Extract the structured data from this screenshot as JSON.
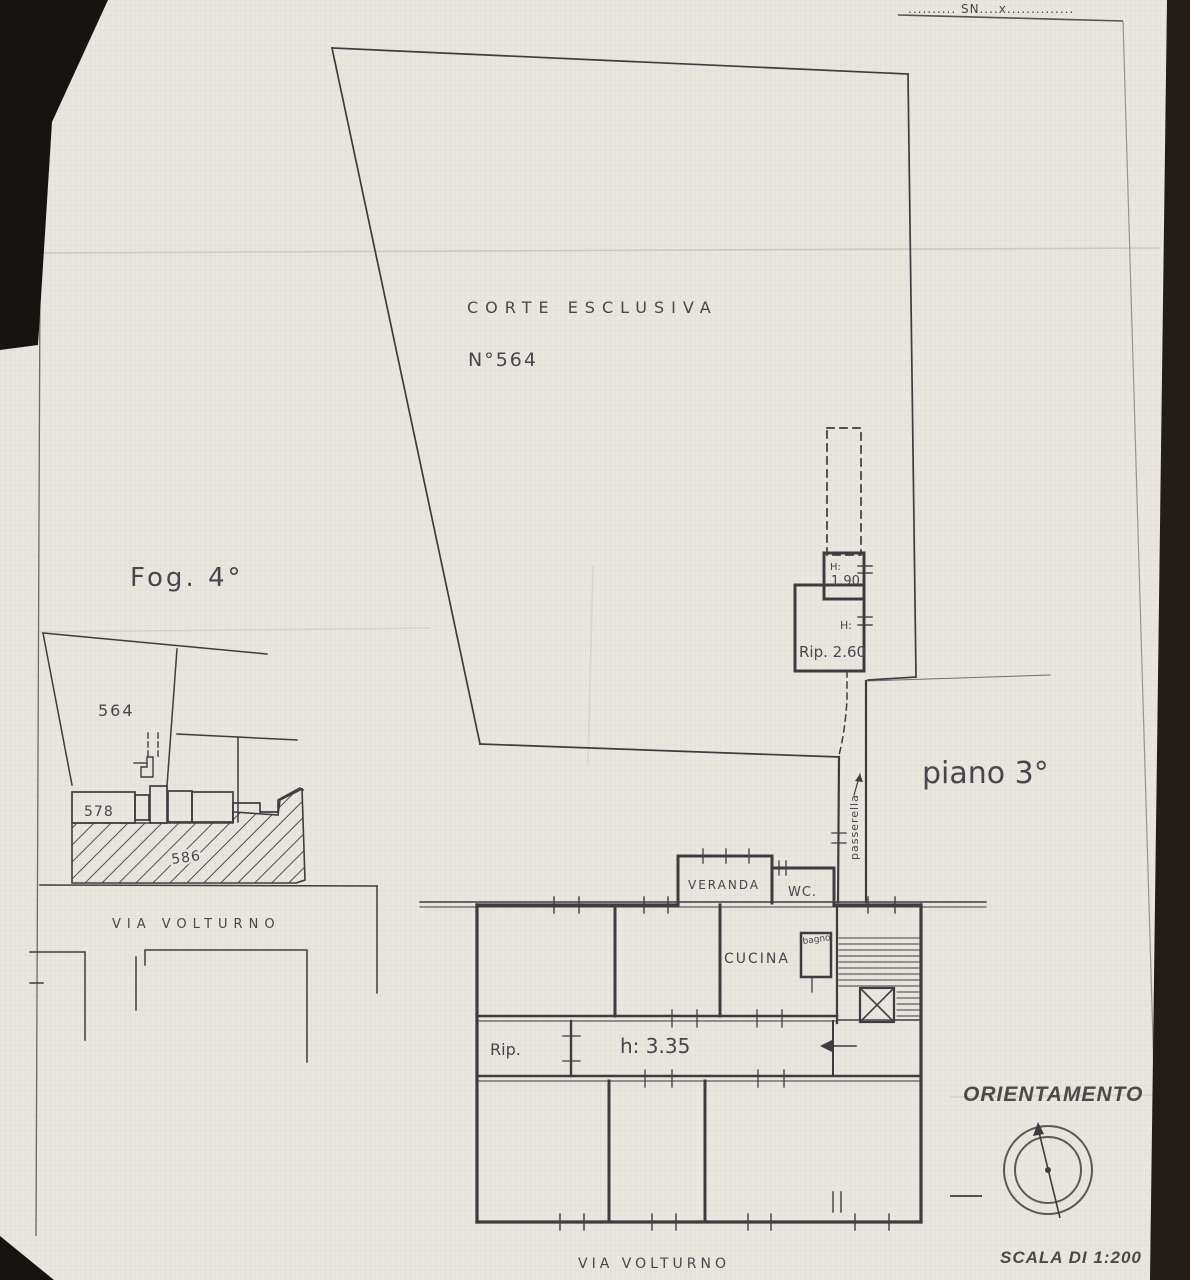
{
  "sheet": {
    "top_note": "..........  SN....x..............",
    "map_title": "Fog. 4°",
    "floor_label": "piano 3°",
    "orientation_title": "ORIENTAMENTO",
    "scale_label": "SCALA DI 1:200",
    "street_bottom": "VIA   VOLTURNO"
  },
  "courtyard": {
    "label": "CORTE   ESCLUSIVA",
    "parcel": "N°564"
  },
  "annex": {
    "h_label_small": "H:",
    "h_value_small": "1.90",
    "h_label": "H:",
    "rip_label": "Rip. 2.60",
    "walkway": "passerella"
  },
  "apartment": {
    "veranda": "VERANDA",
    "wc": "WC.",
    "cucina": "CUCINA",
    "bagno": "bagno",
    "rip": "Rip.",
    "ceiling_height": "h: 3.35"
  },
  "map": {
    "street": "VIA   VOLTURNO",
    "parcel_564": "564",
    "parcel_578": "578",
    "parcel_586": "586"
  }
}
